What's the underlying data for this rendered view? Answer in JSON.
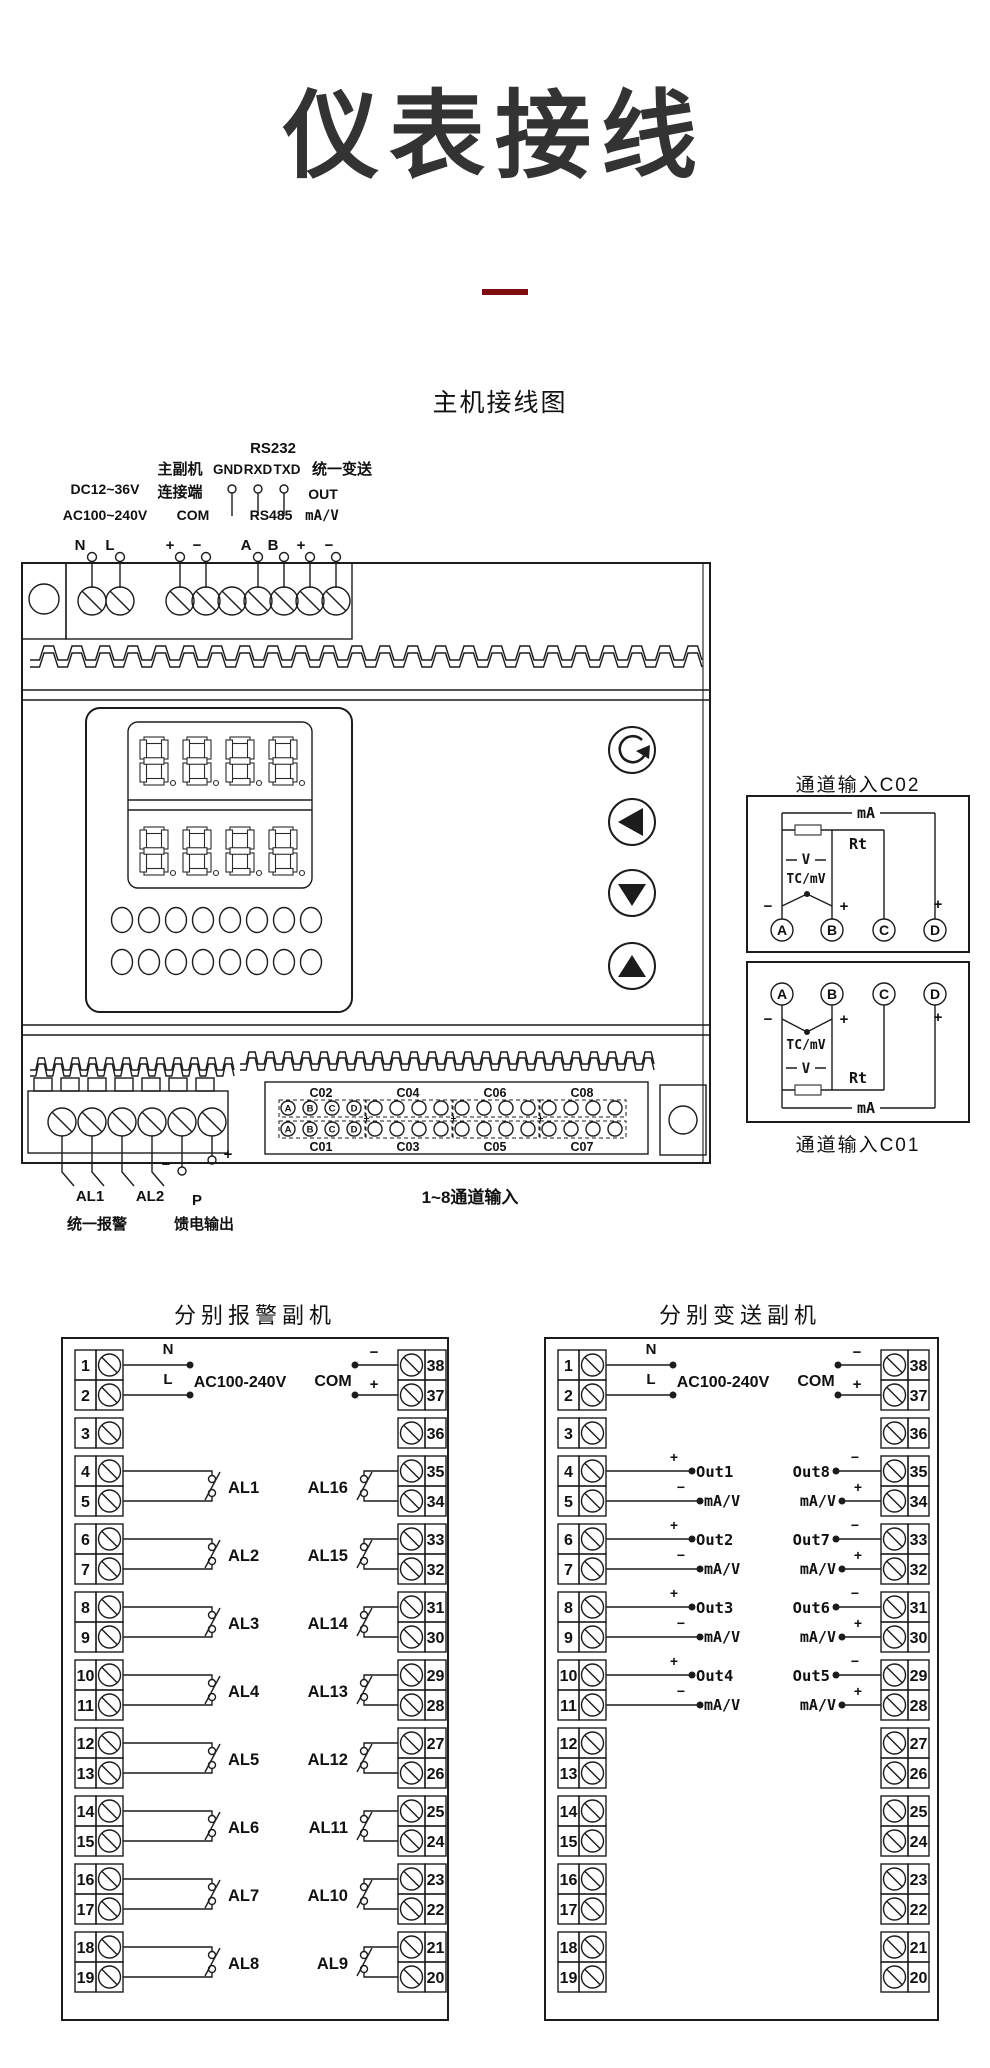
{
  "page": {
    "title": "仪表接线",
    "accent_color": "#7e0d12",
    "main_heading": "主机接线图"
  },
  "main": {
    "top": {
      "rs232": "RS232",
      "master_slave_line1": "主副机",
      "master_slave_line2": "连接端",
      "gnd": "GND",
      "rxd": "RXD",
      "txd": "TXD",
      "unified_transmit": "统一变送",
      "out": "OUT",
      "dc_range": "DC12~36V",
      "ac_range": "AC100~240V",
      "com": "COM",
      "rs485": "RS485",
      "ma_v": "mA/V",
      "n": "N",
      "l": "L",
      "com_plus": "+",
      "com_minus": "−",
      "a": "A",
      "b": "B",
      "out_plus": "+",
      "out_minus": "−"
    },
    "bottom": {
      "al1": "AL1",
      "al2": "AL2",
      "p": "P",
      "p_minus": "−",
      "p_plus": "+",
      "unified_alarm": "统一报警",
      "feed_output": "馈电输出",
      "channel_range": "1~8通道输入",
      "top_channels": [
        "C02",
        "C04",
        "C06",
        "C08"
      ],
      "bottom_channels": [
        "C01",
        "C03",
        "C05",
        "C07"
      ],
      "pins": [
        "A",
        "B",
        "C",
        "D"
      ],
      "plus_separators": [
        "+",
        "+",
        "+"
      ]
    },
    "channel_box": {
      "c02_title": "通道输入C02",
      "c01_title": "通道输入C01",
      "ma": "mA",
      "rt": "Rt",
      "v": "V",
      "tc_mv": "TC/mV",
      "minus": "−",
      "plus": "+",
      "d_plus": "+",
      "pins": [
        "A",
        "B",
        "C",
        "D"
      ]
    }
  },
  "alarm_unit": {
    "title": "分别报警副机",
    "n": "N",
    "l": "L",
    "ac": "AC100-240V",
    "com": "COM",
    "com_minus": "−",
    "com_plus": "+",
    "left_terminals": [
      "1",
      "2",
      "3",
      "4",
      "5",
      "6",
      "7",
      "8",
      "9",
      "10",
      "11",
      "12",
      "13",
      "14",
      "15",
      "16",
      "17",
      "18",
      "19"
    ],
    "right_terminals": [
      "38",
      "37",
      "36",
      "35",
      "34",
      "33",
      "32",
      "31",
      "30",
      "29",
      "28",
      "27",
      "26",
      "25",
      "24",
      "23",
      "22",
      "21",
      "20"
    ],
    "left_relays": [
      "AL1",
      "AL2",
      "AL3",
      "AL4",
      "AL5",
      "AL6",
      "AL7",
      "AL8"
    ],
    "right_relays": [
      "AL16",
      "AL15",
      "AL14",
      "AL13",
      "AL12",
      "AL11",
      "AL10",
      "AL9"
    ]
  },
  "transmit_unit": {
    "title": "分别变送副机",
    "n": "N",
    "l": "L",
    "ac": "AC100-240V",
    "com": "COM",
    "com_minus": "−",
    "com_plus": "+",
    "left_terminals": [
      "1",
      "2",
      "3",
      "4",
      "5",
      "6",
      "7",
      "8",
      "9",
      "10",
      "11",
      "12",
      "13",
      "14",
      "15",
      "16",
      "17",
      "18",
      "19"
    ],
    "right_terminals": [
      "38",
      "37",
      "36",
      "35",
      "34",
      "33",
      "32",
      "31",
      "30",
      "29",
      "28",
      "27",
      "26",
      "25",
      "24",
      "23",
      "22",
      "21",
      "20"
    ],
    "left_outputs": [
      {
        "sign_top": "+",
        "name": "Out1",
        "sign_bottom": "−",
        "unit": "mA/V"
      },
      {
        "sign_top": "+",
        "name": "Out2",
        "sign_bottom": "−",
        "unit": "mA/V"
      },
      {
        "sign_top": "+",
        "name": "Out3",
        "sign_bottom": "−",
        "unit": "mA/V"
      },
      {
        "sign_top": "+",
        "name": "Out4",
        "sign_bottom": "−",
        "unit": "mA/V"
      }
    ],
    "right_outputs": [
      {
        "sign_top": "−",
        "name": "Out8",
        "sign_bottom": "+",
        "unit": "mA/V"
      },
      {
        "sign_top": "−",
        "name": "Out7",
        "sign_bottom": "+",
        "unit": "mA/V"
      },
      {
        "sign_top": "−",
        "name": "Out6",
        "sign_bottom": "+",
        "unit": "mA/V"
      },
      {
        "sign_top": "−",
        "name": "Out5",
        "sign_bottom": "+",
        "unit": "mA/V"
      }
    ]
  }
}
